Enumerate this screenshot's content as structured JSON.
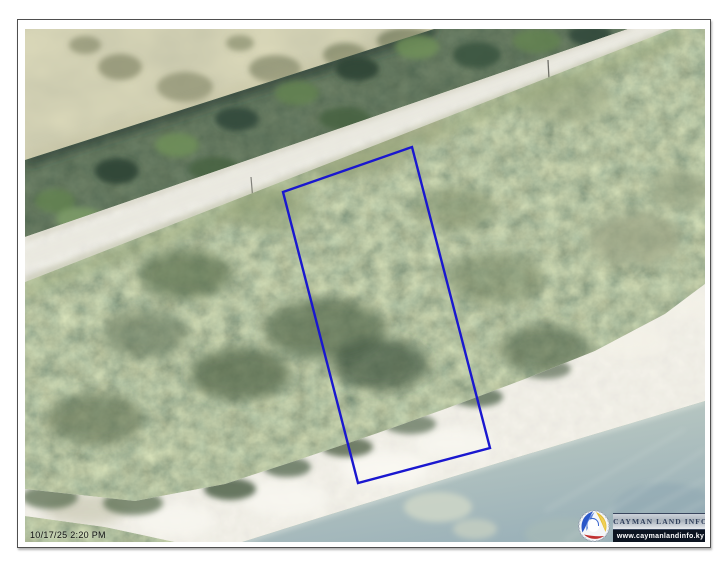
{
  "map": {
    "timestamp": "10/17/25 2:20 PM",
    "scene_features": [
      "lagoon-water",
      "mangrove-tree-line",
      "unpaved-road",
      "scrubland",
      "sandy-beach",
      "shallow-sea",
      "surveyed-parcel-boundary"
    ]
  },
  "parcel": {
    "points": "258,163 387,118 465,419 333,454",
    "outline_color": "#1a17cf"
  },
  "branding": {
    "icon": "cayman-land-info-swirl-icon",
    "name": "CAYMAN LAND INFO",
    "url": "www.caymanlandinfo.ky"
  },
  "colors": {
    "parcel_outline": "#1a17cf",
    "brand_strip_bg": "#0c1420",
    "brand_text": "#31405c",
    "frame_border": "#4f4f4f",
    "lagoon": "#a3a47d",
    "trees": "#3a513c",
    "road": "#d8d7cd",
    "scrub": "#6f7d5c",
    "beach": "#e9e6da",
    "sea_near": "#c8d3c6",
    "sea_far": "#9cb2b9"
  }
}
